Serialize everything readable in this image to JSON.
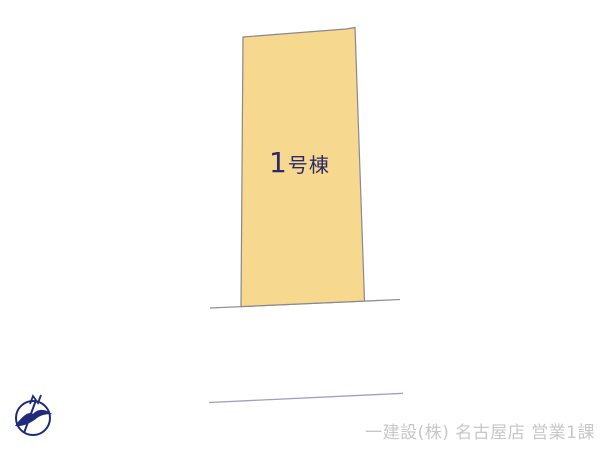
{
  "plan": {
    "lot_label": "1号棟"
  },
  "footer": {
    "company_text": "一建設(株) 名古屋店 営業1課"
  },
  "icons": {
    "compass": "north-compass-icon"
  },
  "colors": {
    "background": "#FFFFFF",
    "lot_fill": "#F6D88F",
    "lot_stroke": "#8B878D",
    "lot_label_text": "#2A2A6A",
    "road_line": "#92909B",
    "boundary_line": "#9E9EC6",
    "watermark_text": "#C7C7C7",
    "compass": "#1F2A78"
  }
}
